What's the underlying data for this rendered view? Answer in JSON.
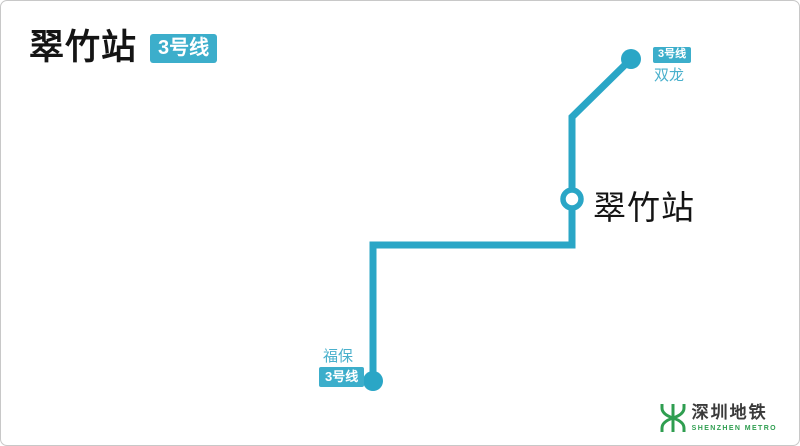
{
  "header": {
    "station_name": "翠竹站",
    "line_badge": "3号线"
  },
  "diagram": {
    "terminus_top": {
      "badge": "3号线",
      "name": "双龙"
    },
    "station": {
      "name": "翠竹站"
    },
    "terminus_bottom": {
      "name": "福保",
      "badge": "3号线"
    }
  },
  "footer": {
    "logo_cn": "深圳地铁",
    "logo_en": "SHENZHEN METRO"
  },
  "colors": {
    "line": "#2aa6c6",
    "badge": "#3caecb",
    "label_teal": "#49b0cc",
    "ink": "#141414",
    "logo_green": "#2f9e50",
    "logo_ink": "#3a3a3a"
  }
}
